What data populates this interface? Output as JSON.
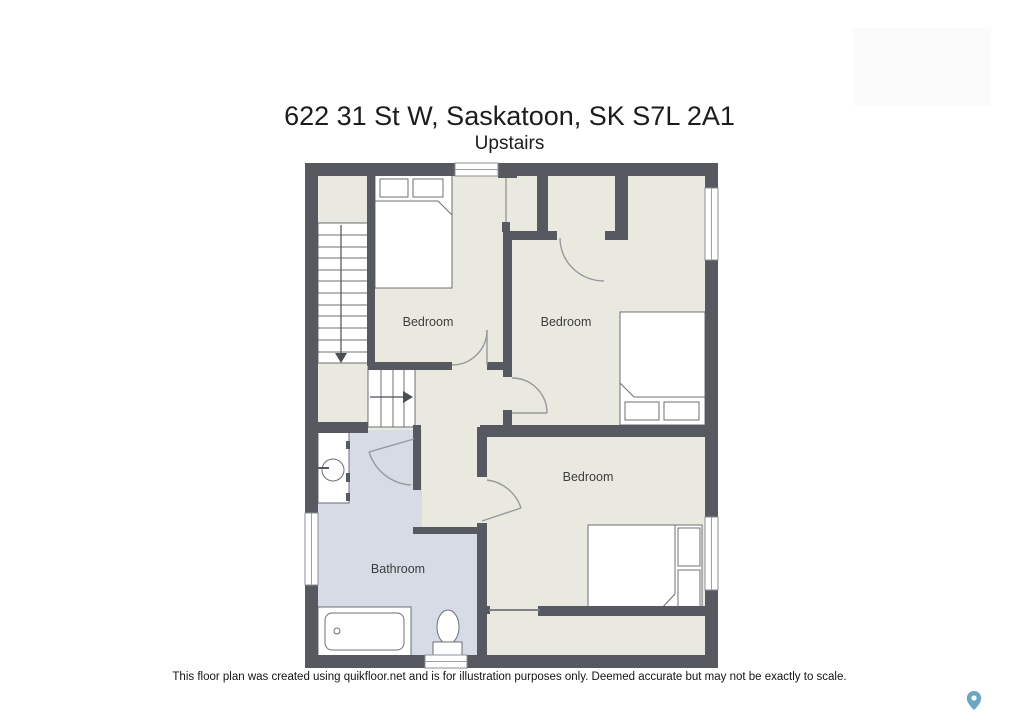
{
  "header": {
    "title": "622 31 St W, Saskatoon, SK S7L 2A1",
    "subtitle": "Upstairs"
  },
  "rooms": [
    {
      "id": "bedroom-top-left",
      "label": "Bedroom"
    },
    {
      "id": "bedroom-top-right",
      "label": "Bedroom"
    },
    {
      "id": "bedroom-bottom-right",
      "label": "Bedroom"
    },
    {
      "id": "bathroom",
      "label": "Bathroom"
    }
  ],
  "footer": {
    "disclaimer": "This floor plan was created using quikfloor.net and is for illustration purposes only. Deemed accurate but may not be exactly to scale."
  },
  "icons": {
    "map_pin": "map-pin-icon"
  },
  "colors": {
    "wall": "#565a60",
    "floor": "#eae9e0",
    "bathroom_floor": "#d6dbe6",
    "pin": "#69a7c5"
  }
}
